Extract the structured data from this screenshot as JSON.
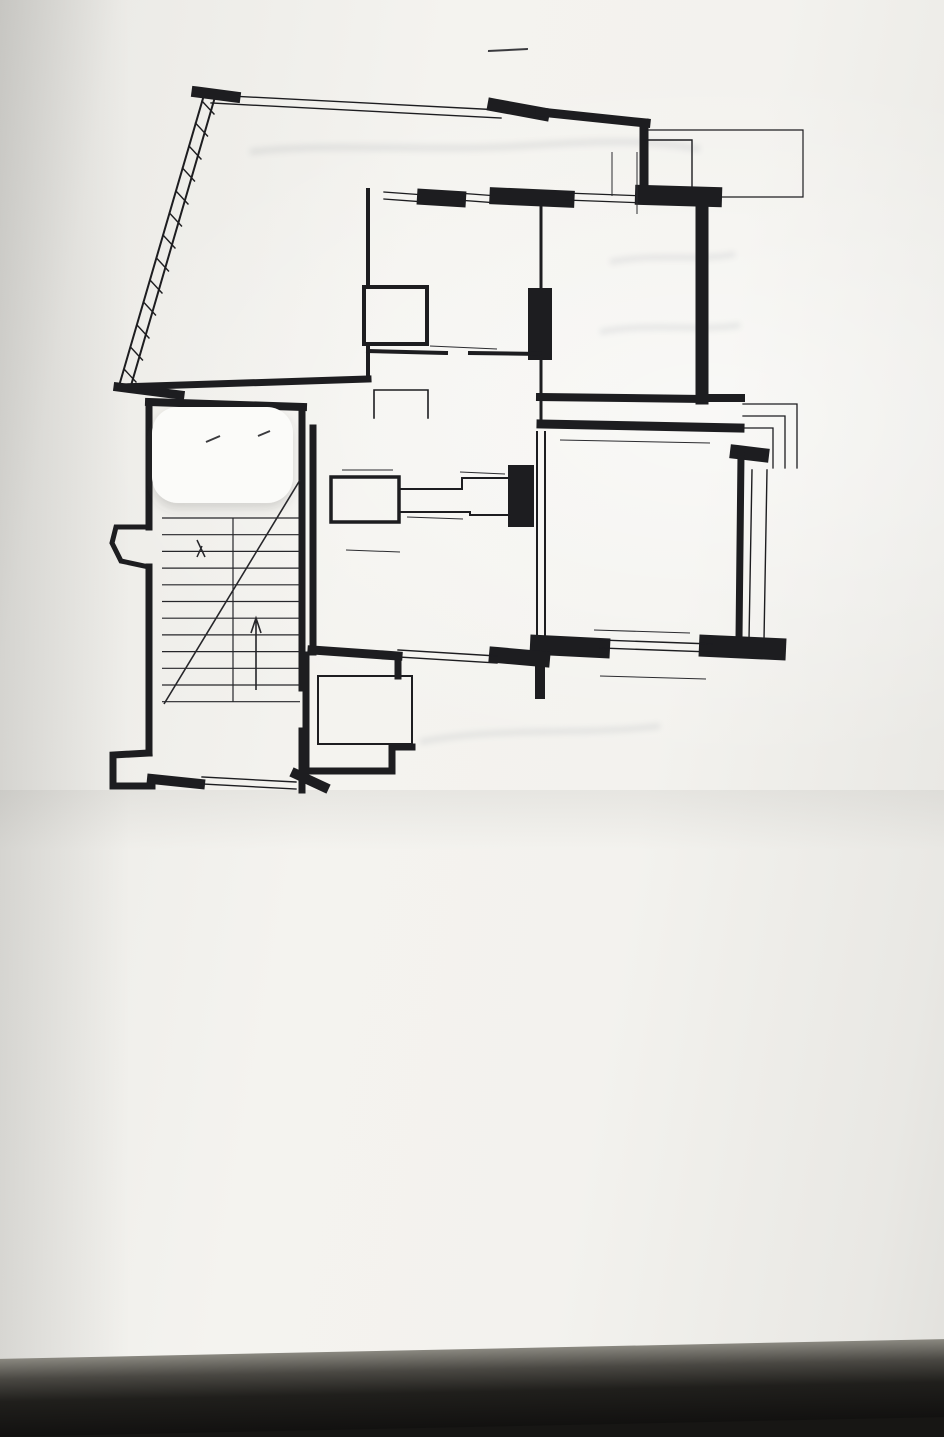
{
  "header": {
    "plan_title": "ПЛАН  КВАРТИРИ   М 1:100",
    "struck_scale": "(200)",
    "floor_note": "1й поверх"
  },
  "plan": {
    "height_note": {
      "t": "h = 3.00",
      "x": 612,
      "y": 449
    },
    "rooms": [
      {
        "num": "2",
        "area": "23,5",
        "x": 270,
        "y": 212
      },
      {
        "num": "5",
        "area": "9,2",
        "x": 459,
        "y": 248
      },
      {
        "num": "4",
        "area": "0,9",
        "x": 381,
        "y": 301
      },
      {
        "num": "3",
        "area": "2,2",
        "x": 624,
        "y": 157,
        "r": -14
      },
      {
        "num": "6",
        "area": "16,8",
        "x": 622,
        "y": 300
      },
      {
        "num": "1",
        "area": "10,8",
        "x": 456,
        "y": 412
      },
      {
        "num": "9",
        "area": "1,5",
        "x": 367,
        "y": 494
      },
      {
        "num": "7",
        "area": "20,9",
        "x": 637,
        "y": 522
      },
      {
        "num": "8",
        "area": "12,1",
        "x": 424,
        "y": 580
      },
      {
        "num": "I",
        "area": "2,0",
        "x": 346,
        "y": 702
      }
    ],
    "dims": [
      {
        "t": "3,44",
        "x": 270,
        "y": 126,
        "r": -9
      },
      {
        "t": "1,62",
        "x": 608,
        "y": 172,
        "r": -83
      },
      {
        "t": "0,39",
        "x": 347,
        "y": 211,
        "r": -5
      },
      {
        "t": "3,27",
        "x": 450,
        "y": 213,
        "r": -6
      },
      {
        "t": "3,89",
        "x": 634,
        "y": 216,
        "r": -4
      },
      {
        "t": "6,48",
        "x": 183,
        "y": 247,
        "r": -73
      },
      {
        "t": "2,01",
        "x": 372,
        "y": 248,
        "r": -84
      },
      {
        "t": "1,93",
        "x": 533,
        "y": 241,
        "r": -84
      },
      {
        "t": "3,19",
        "x": 507,
        "y": 268,
        "r": -80
      },
      {
        "t": "4,45",
        "x": 691,
        "y": 287,
        "r": -82
      },
      {
        "t": "4,87",
        "x": 733,
        "y": 290,
        "r": -80
      },
      {
        "t": "4,44",
        "x": 350,
        "y": 297,
        "r": -78
      },
      {
        "t": "1,01",
        "x": 391,
        "y": 280,
        "r": -6
      },
      {
        "t": "1,18",
        "x": 422,
        "y": 313,
        "r": -58
      },
      {
        "t": "1,42",
        "x": 545,
        "y": 316,
        "r": -84
      },
      {
        "t": "0,39",
        "x": 539,
        "y": 281,
        "r": 0
      },
      {
        "t": "2,24",
        "x": 459,
        "y": 336,
        "r": -4
      },
      {
        "t": "3,26",
        "x": 447,
        "y": 357,
        "r": -4
      },
      {
        "t": "0,39",
        "x": 541,
        "y": 358,
        "r": 0
      },
      {
        "t": "1,10",
        "x": 344,
        "y": 364,
        "r": -80
      },
      {
        "t": "1,13",
        "x": 533,
        "y": 389,
        "r": -84
      },
      {
        "t": "3,82",
        "x": 268,
        "y": 386,
        "r": -4
      },
      {
        "t": "1,01",
        "x": 393,
        "y": 385,
        "r": -5
      },
      {
        "t": "0,86",
        "x": 379,
        "y": 404,
        "r": -4
      },
      {
        "t": "0,66",
        "x": 414,
        "y": 407,
        "r": -72
      },
      {
        "t": "0,61",
        "x": 343,
        "y": 416,
        "r": -4
      },
      {
        "t": "3,91",
        "x": 618,
        "y": 393,
        "r": -3
      },
      {
        "t": "0,88",
        "x": 741,
        "y": 401,
        "r": -4
      },
      {
        "t": "2,94",
        "x": 511,
        "y": 420,
        "r": -84
      },
      {
        "t": "4,40",
        "x": 635,
        "y": 431,
        "r": -4
      },
      {
        "t": "1,39",
        "x": 347,
        "y": 450,
        "r": -74
      },
      {
        "t": "1,65",
        "x": 364,
        "y": 464,
        "r": -6
      },
      {
        "t": "1,50",
        "x": 362,
        "y": 478,
        "r": -6
      },
      {
        "t": "0,55",
        "x": 433,
        "y": 479,
        "r": -74
      },
      {
        "t": "0,52",
        "x": 455,
        "y": 477,
        "r": -80
      },
      {
        "t": "1,10",
        "x": 480,
        "y": 467,
        "r": -6
      },
      {
        "t": "0,94",
        "x": 493,
        "y": 491,
        "r": -5
      },
      {
        "t": "1,13",
        "x": 438,
        "y": 492,
        "r": -16
      },
      {
        "t": "1,29",
        "x": 435,
        "y": 512,
        "r": -5
      },
      {
        "t": "0,52",
        "x": 467,
        "y": 509,
        "r": -80
      },
      {
        "t": "2,07",
        "x": 544,
        "y": 467,
        "r": -84
      },
      {
        "t": "0,98",
        "x": 391,
        "y": 499,
        "r": -84
      },
      {
        "t": "0,58",
        "x": 412,
        "y": 530,
        "r": -74
      },
      {
        "t": "1,62",
        "x": 373,
        "y": 545,
        "r": -5
      },
      {
        "t": "0,40",
        "x": 532,
        "y": 521,
        "r": -70
      },
      {
        "t": "2,67",
        "x": 333,
        "y": 590,
        "r": -84
      },
      {
        "t": "4,69",
        "x": 421,
        "y": 627,
        "r": -68,
        "s": true
      },
      {
        "t": "3,80",
        "x": 507,
        "y": 577,
        "r": -84
      },
      {
        "t": "2,11",
        "x": 528,
        "y": 563,
        "r": -80
      },
      {
        "t": "0,40",
        "x": 532,
        "y": 624,
        "r": -70
      },
      {
        "t": "0,39",
        "x": 543,
        "y": 661,
        "r": -84
      },
      {
        "t": "3,87",
        "x": 428,
        "y": 648,
        "r": -4
      },
      {
        "t": "4,40",
        "x": 645,
        "y": 621,
        "r": -4
      },
      {
        "t": "4,83",
        "x": 652,
        "y": 666,
        "r": -4
      },
      {
        "t": "0,86",
        "x": 544,
        "y": 690,
        "r": -84
      },
      {
        "t": "4,57",
        "x": 713,
        "y": 521,
        "r": -74
      },
      {
        "t": "5,44",
        "x": 777,
        "y": 517,
        "r": -87
      },
      {
        "t": "1,29",
        "x": 341,
        "y": 685,
        "r": -5
      },
      {
        "t": "1,55",
        "x": 318,
        "y": 718,
        "r": -75
      },
      {
        "t": "2,66",
        "x": 209,
        "y": 761,
        "r": -4
      }
    ]
  },
  "form": {
    "title": "ТЕХНІЧНА ХАРАКТЕРИСТИКА КВАРТИРИ",
    "lines": [
      {
        "ind": 36,
        "segs": [
          {
            "t": "Квартира (посімейного, спільного заселення) розташована на"
          },
          {
            "w": "1му",
            "wd": 70
          },
          {
            "t": "поверсі"
          },
          {
            "w": "3х",
            "wd": 66
          },
          {
            "t": "поверхо-"
          }
        ]
      },
      {
        "ind": 0,
        "segs": [
          {
            "t": "ого будинку та складається з"
          },
          {
            "w": "3х",
            "wd": 90
          },
          {
            "t": "кімнат, житловою площею"
          },
          {
            "w": "61.2",
            "wd": 84
          },
          {
            "t": "кв.м., в тому числі:"
          }
        ]
      },
      {
        "ind": 0,
        "segs": [
          {
            "t": "а кімната"
          },
          {
            "w": "23.5",
            "wd": 90
          },
          {
            "t": "2-га кімната"
          },
          {
            "w": "16.8",
            "wd": 92
          },
          {
            "t": "3-я кімната"
          },
          {
            "w": "20.9",
            "wd": 92
          },
          {
            "t": "4-та кімната"
          },
          {
            "b": 96
          },
          {
            "t": "5-та кімна-"
          }
        ]
      },
      {
        "ind": 0,
        "segs": [
          {
            "b": 54
          },
          {
            "t": "кухня площею"
          },
          {
            "w": "12.1",
            "wd": 84
          },
          {
            "t": "кв.м., ванна кімната площею"
          },
          {
            "w": "9.2",
            "wd": 84
          },
          {
            "t": "кв.м., вбиральня (поєдна-"
          }
        ]
      },
      {
        "ind": 0,
        "segs": [
          {
            "t": ")"
          },
          {
            "w": "1.5",
            "wd": 78
          },
          {
            "t": "кв. м., коридор"
          },
          {
            "w": "10.8",
            "wd": 92
          },
          {
            "t": "кв.м., комірка"
          },
          {
            "w": "0.9",
            "wd": 80
          },
          {
            "t": "кв.м., вбудована шафа"
          },
          {
            "b": 78
          },
          {
            "t": "кв.м.,"
          }
        ]
      },
      {
        "ind": 0,
        "segs": [
          {
            "t": "ранда"
          },
          {
            "b": 78
          },
          {
            "t": "кв.м. Підвал"
          },
          {
            "b": 96
          },
          {
            "t": "кв.м.,"
          }
        ]
      },
      {
        "ind": 14,
        "segs": [
          {
            "t": "Квартира обладнана балконом (терасою, лоджією)."
          },
          {
            "w": "2.2",
            "wd": 70
          },
          {
            "t": "кв.м."
          }
        ]
      },
      {
        "ind": 10,
        "segs": [
          {
            "t": "Загальна площа квартири"
          },
          {
            "w": "97.9",
            "wd": 168
          },
          {
            "t": "кв.м. Висота приміщень"
          },
          {
            "w": "3.0",
            "wd": 150
          },
          {
            "t": "м."
          }
        ]
      },
      {
        "ind": 6,
        "segs": [
          {
            "t": "Відновлена вартість квартири"
          },
          {
            "b": 170
          },
          {
            "t": "грн."
          }
        ]
      },
      {
        "ind": 0,
        "segs": [
          {
            "t": "матеріал зовнішніх стін"
          },
          {
            "w": "цегляні",
            "wd": 150
          },
          {
            "t": "матеріал перекриття"
          },
          {
            "w": "з/бетон",
            "wd": 225
          }
        ]
      }
    ],
    "equipped_heading": "Квартиру обладнано:",
    "equipped_line1": "водопроводом (холодним, гарячим), каналізацією, газопостачанням, опаленням",
    "equipped_note": "(вказати яким)",
    "equipped_line2_underlined": "електроосвітленням, радіотрансляційною мережею",
    "equipped_line2_rest": ", сміттєвідводом, ліфтом.",
    "composed_label": "клав:",
    "composed_sign": "Н /Чорнобай/",
    "checked_label": "Перевірив:",
    "checked_sign": "ІМ   Ціцяло",
    "print_note": "укарня,  зам.546,  т.5000.—2002р.  (т.5-16-77)"
  }
}
